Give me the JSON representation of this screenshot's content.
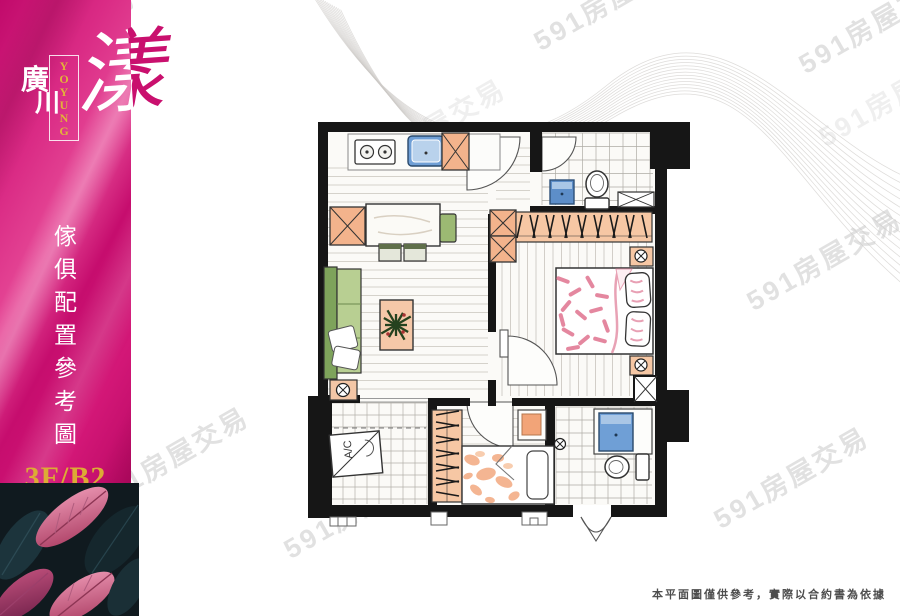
{
  "brand": {
    "char1": "廣",
    "char2": "川",
    "main_char": "漾",
    "en": [
      "Y",
      "O",
      "Y",
      "U",
      "N",
      "G"
    ]
  },
  "sidebar": {
    "vertical_title": [
      "傢",
      "俱",
      "配",
      "置",
      "參",
      "考",
      "圖"
    ],
    "floor_label": "3F/B2"
  },
  "watermark": {
    "text": "591房屋交易"
  },
  "floorplan": {
    "ac_label": "A/C"
  },
  "footer": {
    "disclaimer": "本平面圖僅供參考，實際以合約書為依據"
  },
  "colors": {
    "panel_dark": "#b30560",
    "panel_light": "#e64a97",
    "gold": "#dcab35",
    "wall_black": "#161616",
    "cabinet_orange": "#f3b38c",
    "fixture_blue": "#5d8ec9",
    "sofa_green": "#9cb973",
    "bed_pink": "#e0738f",
    "bed_peach": "#f2a478"
  }
}
